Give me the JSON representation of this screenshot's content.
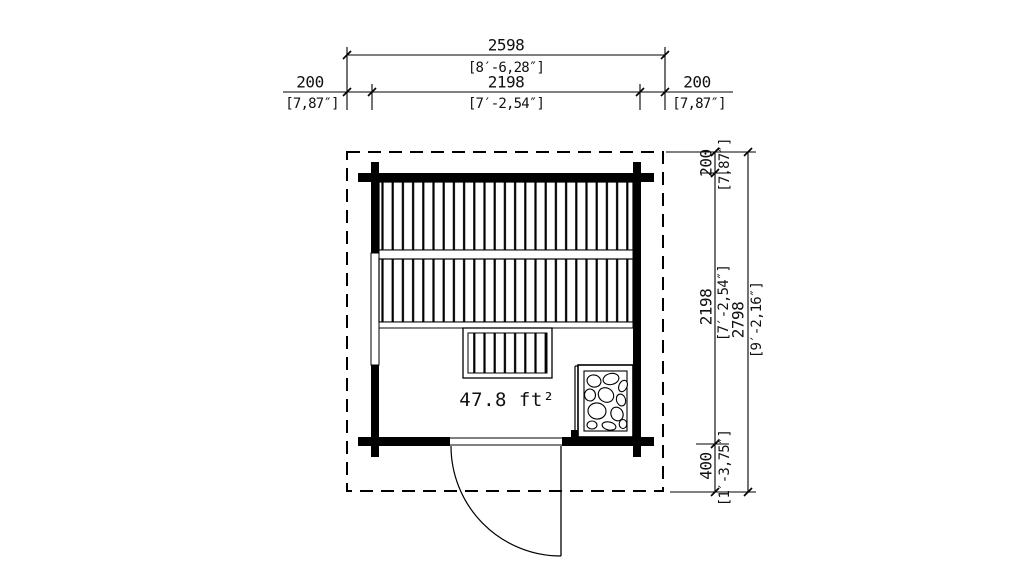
{
  "colors": {
    "line": "#000000",
    "background": "#ffffff"
  },
  "plan": {
    "area_label": "47.8 ft²"
  },
  "dims_top": {
    "total_mm": "2598",
    "total_imp": "[8′-6,28″]",
    "left_mm": "200",
    "left_imp": "[7,87″]",
    "width_mm": "2198",
    "width_imp": "[7′-2,54″]",
    "right_mm": "200",
    "right_imp": "[7,87″]"
  },
  "dims_right": {
    "overhang_mm": "200",
    "overhang_imp": "[7,87″]",
    "depth_mm": "2198",
    "depth_imp": "[7′-2,54″]",
    "total_mm": "2798",
    "total_imp": "[9′-2,16″]",
    "canopy_mm": "400",
    "canopy_imp": "[1′-3,75″]"
  }
}
